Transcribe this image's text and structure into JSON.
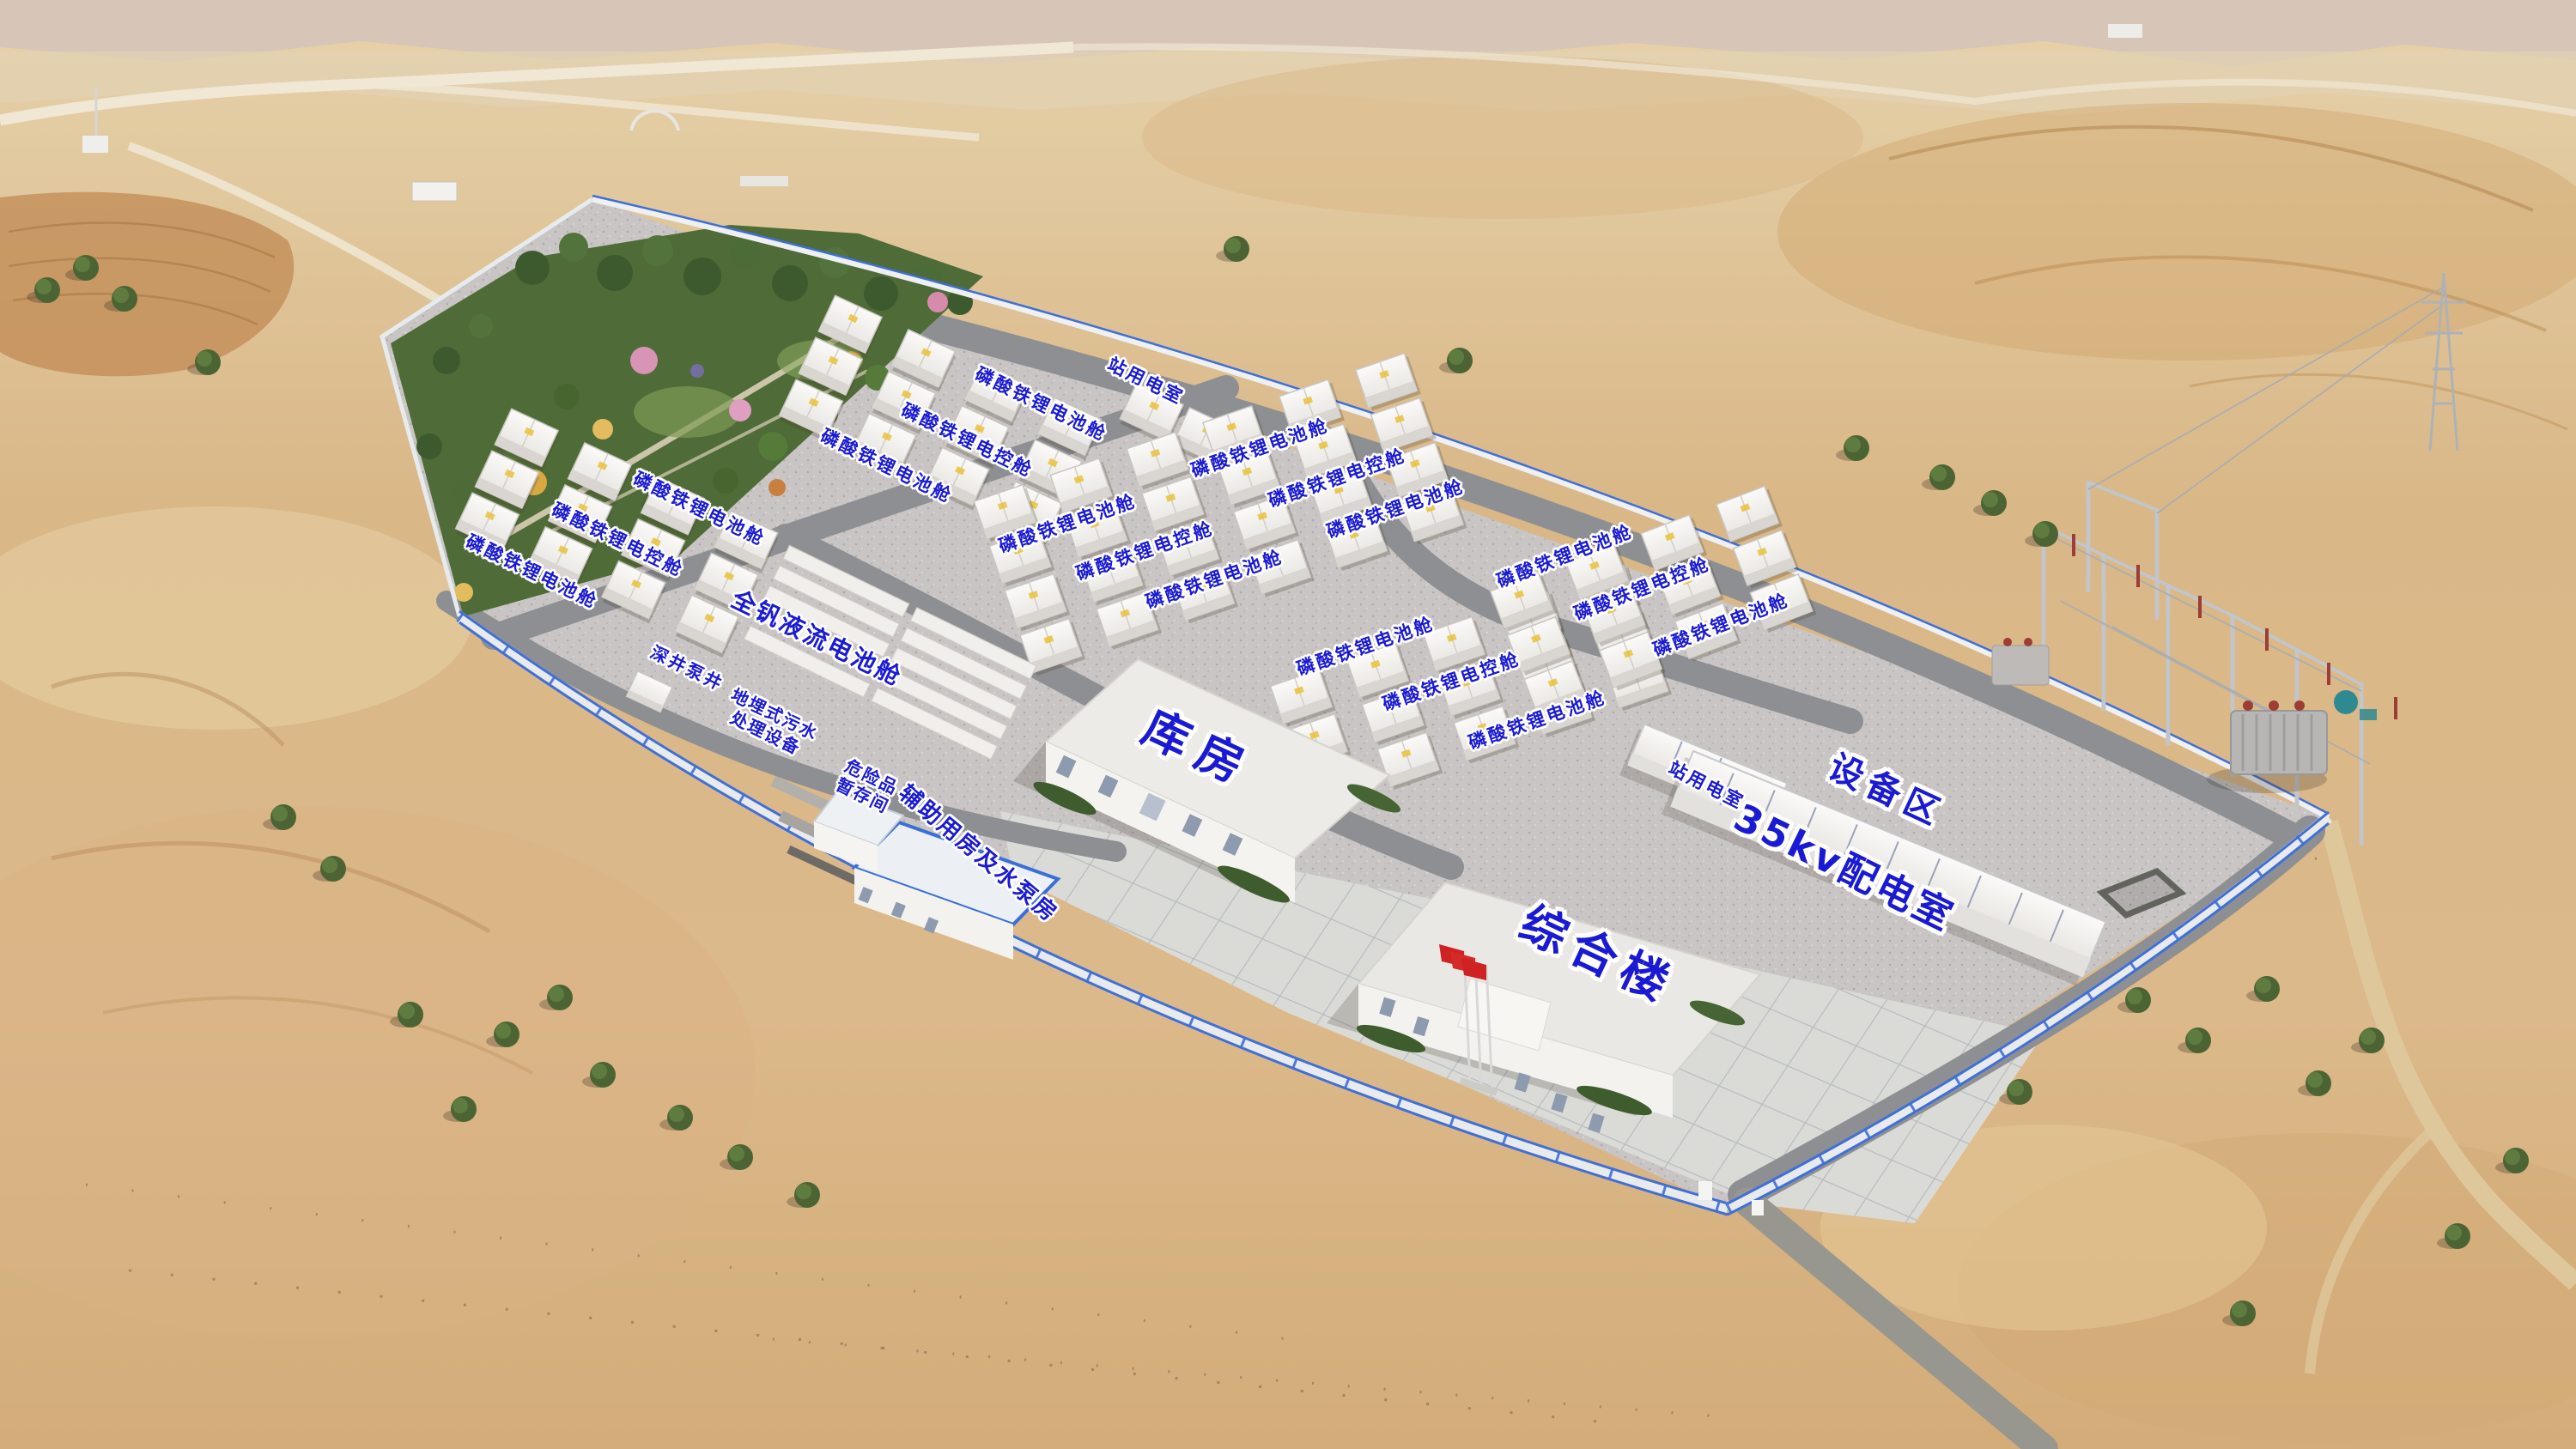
{
  "scene": {
    "type": "aerial-3d-render",
    "description_visible_text_only": true,
    "colors": {
      "label_blue": "#1a1ad4",
      "label_outline": "#ffffff",
      "fence_blue": "#3f6fd8",
      "sand": "#dcbd90",
      "road_gray": "#8d8f93",
      "gravel_gray": "#c9c5c4",
      "container_white": "#f4f2ef",
      "park_green": "#4f6b37",
      "flag_red": "#cf2222"
    }
  },
  "labels": {
    "lfp_battery_cabin": "磷酸铁锂电池舱",
    "lfp_control_cabin": "磷酸铁锂电控舱",
    "vanadium_flow_cabin": "全钒液流电池舱",
    "station_power_room": "站用电室",
    "deep_well_pump": "深井泵井",
    "sewage_line1": "地埋式污水",
    "sewage_line2": "处理设备",
    "hazmat_line1": "危险品",
    "hazmat_line2": "暂存间",
    "aux_pump_house": "辅助用房及水泵房",
    "warehouse": "库房",
    "kv35_distribution_room": "35kv配电室",
    "equipment_area": "设备区",
    "comprehensive_building": "综合楼"
  }
}
